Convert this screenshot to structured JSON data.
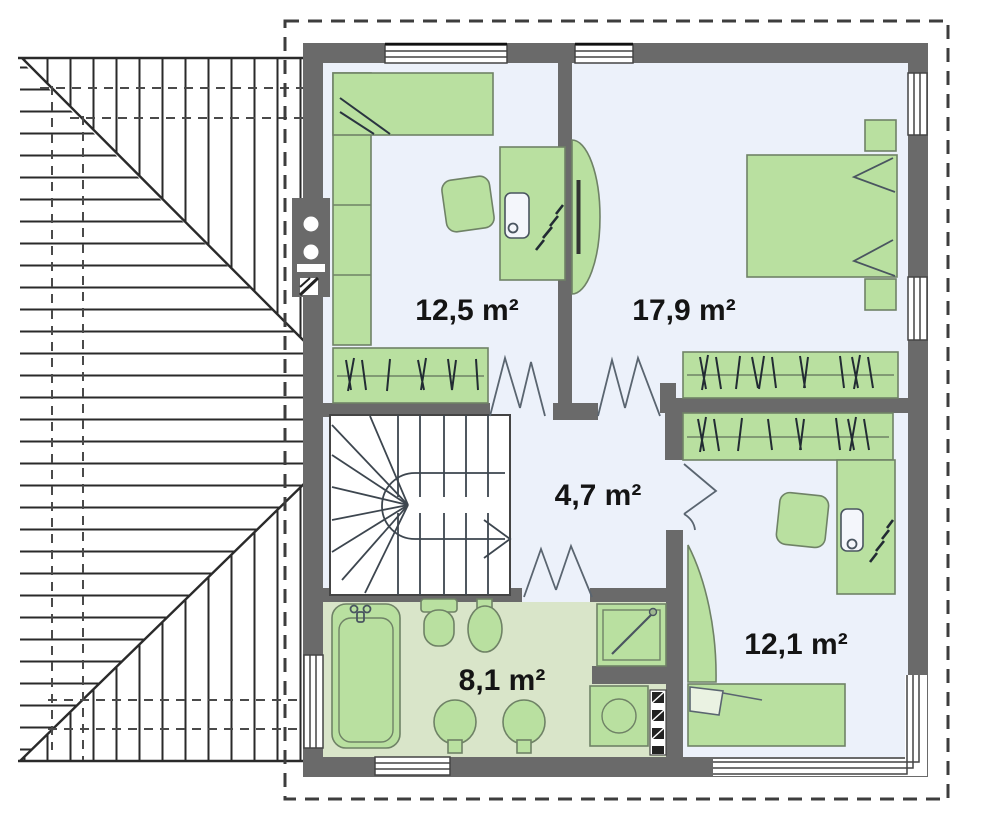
{
  "plan": {
    "type": "upper-floor-plan-with-roof",
    "rooms": [
      {
        "name": "room-top-left",
        "area_label": "12,5 m²"
      },
      {
        "name": "bedroom-top-right",
        "area_label": "17,9 m²"
      },
      {
        "name": "hallway-center",
        "area_label": "4,7 m²"
      },
      {
        "name": "bathroom-bottom",
        "area_label": "8,1 m²"
      },
      {
        "name": "room-bottom-right",
        "area_label": "12,1 m²"
      }
    ],
    "symbols": [
      "roof-hatch",
      "dashed-outline",
      "chimney",
      "window",
      "corner-window",
      "wardrobe-hanger-rail",
      "staircase-winder",
      "stair-direction-arrow",
      "door-swing",
      "bed",
      "sofa",
      "armchair",
      "desk",
      "desk-chair",
      "plant",
      "tv-console",
      "nightstand",
      "bathtub",
      "toilet",
      "bidet",
      "washbasin",
      "shower",
      "washing-machine",
      "duct-shaft"
    ],
    "colors": {
      "wall": "#6a6a6a",
      "furniture_fill": "#b9e0a0",
      "furniture_stroke": "#6f8266",
      "room_floor": "#ecf1fa",
      "bathroom_floor": "#d9e5c9",
      "label_text": "#141414",
      "roof_line": "#2a2a2a",
      "dashed_outline": "#3d3d3d"
    }
  }
}
